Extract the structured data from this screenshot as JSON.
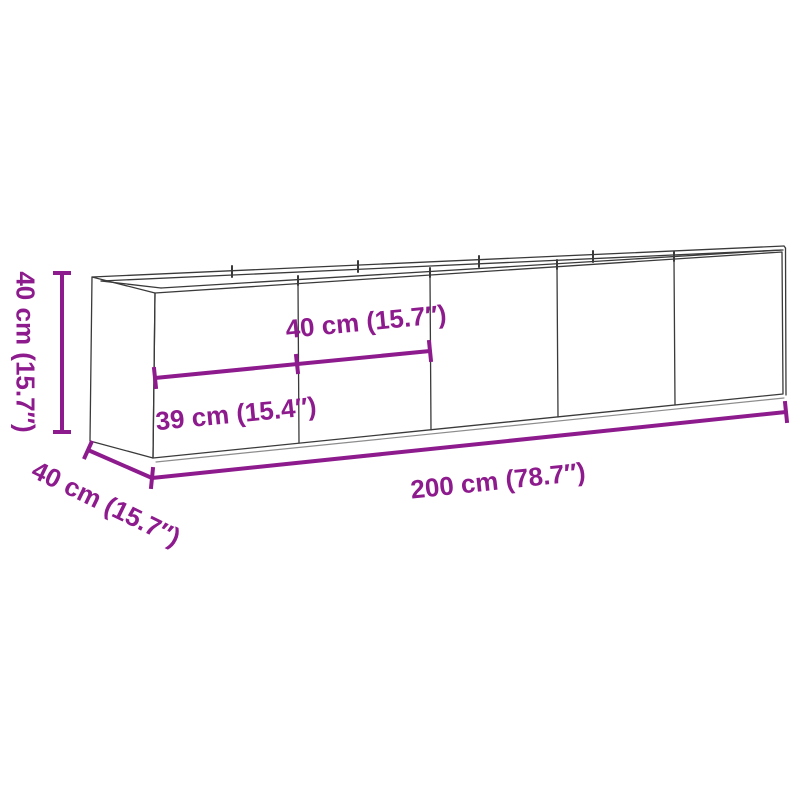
{
  "diagram": {
    "type": "product-dimension-diagram",
    "product": "rectangular-planter-wireframe",
    "dimensions": {
      "height": {
        "label": "40 cm (15.7″)",
        "cm": 40,
        "inches": 15.7
      },
      "depth": {
        "label": "40 cm (15.7″)",
        "cm": 40,
        "inches": 15.7
      },
      "width": {
        "label": "200 cm (78.7″)",
        "cm": 200,
        "inches": 78.7
      },
      "panel_width": {
        "label": "40 cm (15.7″)",
        "cm": 40,
        "inches": 15.7
      },
      "end_panel_width": {
        "label": "39 cm (15.4″)",
        "cm": 39,
        "inches": 15.4
      }
    },
    "colors": {
      "dimension_accent": "#8D1B8D",
      "wireframe": "#3A3A3A",
      "wireframe_light": "#8C8C8C",
      "background": "#FFFFFF"
    }
  }
}
